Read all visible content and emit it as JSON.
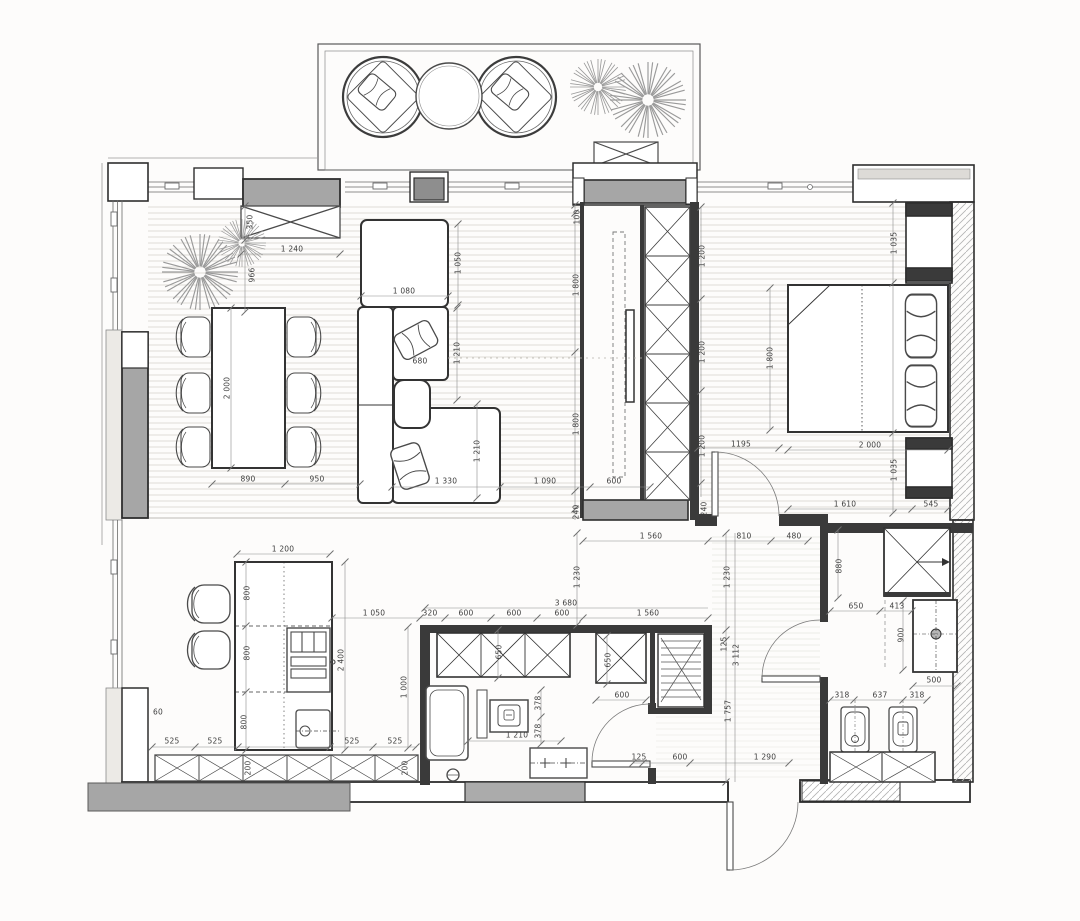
{
  "plan": {
    "title": "apartment-floor-plan",
    "units": "mm",
    "rooms": [
      "balcony",
      "living-dining-room",
      "bedroom",
      "kitchen",
      "bathroom-laundry",
      "hallway",
      "bathroom-2",
      "entrance-corridor"
    ],
    "furniture": [
      "lounge-chair",
      "lounge-chair",
      "round-coffee-table",
      "plant",
      "plant",
      "balcony-storage-box",
      "radiator-cabinet",
      "dining-table",
      "dining-chair-x6",
      "plant",
      "plant",
      "square-lounge-table",
      "corner-sofa",
      "ottoman",
      "chaise",
      "pillows",
      "tv",
      "tv-console",
      "wardrobe",
      "double-bed",
      "bed-pillow",
      "bed-pillow",
      "nightstand",
      "nightstand",
      "kitchen-island",
      "cooktop-oven",
      "island-sink",
      "bar-stool",
      "bar-stool",
      "base-cabinet-row",
      "wall-cabinet-row",
      "storage-box",
      "linen-closet",
      "bathtub",
      "washing-machine",
      "vanity-basin",
      "floor-drain",
      "shower",
      "vanity-sink",
      "toilet",
      "bidet",
      "bathroom-cabinets"
    ],
    "doors": [
      "bedroom-door",
      "bathroom-door",
      "bathroom2-door",
      "entrance-door"
    ],
    "colors": {
      "paper": "#fdfcfb",
      "wall_dark": "#2e2e2e",
      "wall_gray": "#a6a6a6",
      "wall_light": "#e9e7e3",
      "floor_line": "#dcd9d3",
      "dim_line": "#8c8c8c",
      "dim_text": "#3e3e3e"
    }
  },
  "dimensions": {
    "horizontal": [
      {
        "label": "1 240",
        "x": 292,
        "y": 249
      },
      {
        "label": "1 080",
        "x": 404,
        "y": 291
      },
      {
        "label": "680",
        "x": 420,
        "y": 361
      },
      {
        "label": "890",
        "x": 248,
        "y": 479
      },
      {
        "label": "950",
        "x": 317,
        "y": 479
      },
      {
        "label": "1 330",
        "x": 446,
        "y": 481
      },
      {
        "label": "1 090",
        "x": 545,
        "y": 481
      },
      {
        "label": "600",
        "x": 614,
        "y": 481
      },
      {
        "label": "1195",
        "x": 741,
        "y": 444
      },
      {
        "label": "2 000",
        "x": 870,
        "y": 445
      },
      {
        "label": "1 610",
        "x": 845,
        "y": 504
      },
      {
        "label": "545",
        "x": 931,
        "y": 504
      },
      {
        "label": "1 560",
        "x": 651,
        "y": 536
      },
      {
        "label": "810",
        "x": 744,
        "y": 536
      },
      {
        "label": "480",
        "x": 794,
        "y": 536
      },
      {
        "label": "1 200",
        "x": 283,
        "y": 549
      },
      {
        "label": "3 680",
        "x": 566,
        "y": 603
      },
      {
        "label": "1 050",
        "x": 374,
        "y": 613
      },
      {
        "label": "320",
        "x": 430,
        "y": 613
      },
      {
        "label": "600",
        "x": 466,
        "y": 613
      },
      {
        "label": "600",
        "x": 514,
        "y": 613
      },
      {
        "label": "600",
        "x": 562,
        "y": 613
      },
      {
        "label": "1 560",
        "x": 648,
        "y": 613
      },
      {
        "label": "650",
        "x": 856,
        "y": 606
      },
      {
        "label": "413",
        "x": 897,
        "y": 606
      },
      {
        "label": "600",
        "x": 622,
        "y": 695
      },
      {
        "label": "1 210",
        "x": 517,
        "y": 735
      },
      {
        "label": "525",
        "x": 172,
        "y": 741
      },
      {
        "label": "525",
        "x": 215,
        "y": 741
      },
      {
        "label": "525",
        "x": 352,
        "y": 741
      },
      {
        "label": "525",
        "x": 395,
        "y": 741
      },
      {
        "label": "125",
        "x": 639,
        "y": 757
      },
      {
        "label": "600",
        "x": 680,
        "y": 757
      },
      {
        "label": "1 290",
        "x": 765,
        "y": 757
      },
      {
        "label": "318",
        "x": 842,
        "y": 695
      },
      {
        "label": "637",
        "x": 880,
        "y": 695
      },
      {
        "label": "318",
        "x": 917,
        "y": 695
      },
      {
        "label": "500",
        "x": 934,
        "y": 680
      },
      {
        "label": "60",
        "x": 158,
        "y": 712
      }
    ],
    "vertical": [
      {
        "label": "350",
        "x": 250,
        "y": 222
      },
      {
        "label": "966",
        "x": 252,
        "y": 275
      },
      {
        "label": "100",
        "x": 577,
        "y": 217
      },
      {
        "label": "1 050",
        "x": 458,
        "y": 263
      },
      {
        "label": "1 800",
        "x": 576,
        "y": 285
      },
      {
        "label": "1 210",
        "x": 457,
        "y": 353
      },
      {
        "label": "2 000",
        "x": 227,
        "y": 388
      },
      {
        "label": "1 800",
        "x": 576,
        "y": 424
      },
      {
        "label": "1 210",
        "x": 477,
        "y": 451
      },
      {
        "label": "1 200",
        "x": 702,
        "y": 256
      },
      {
        "label": "1 200",
        "x": 702,
        "y": 352
      },
      {
        "label": "1 200",
        "x": 702,
        "y": 446
      },
      {
        "label": "1 800",
        "x": 770,
        "y": 358
      },
      {
        "label": "1 035",
        "x": 894,
        "y": 243
      },
      {
        "label": "1 035",
        "x": 894,
        "y": 470
      },
      {
        "label": "240",
        "x": 576,
        "y": 512
      },
      {
        "label": "240",
        "x": 704,
        "y": 509
      },
      {
        "label": "1 230",
        "x": 577,
        "y": 577
      },
      {
        "label": "1 230",
        "x": 727,
        "y": 577
      },
      {
        "label": "800",
        "x": 247,
        "y": 593
      },
      {
        "label": "800",
        "x": 247,
        "y": 653
      },
      {
        "label": "800",
        "x": 244,
        "y": 722
      },
      {
        "label": "2 400",
        "x": 341,
        "y": 660
      },
      {
        "label": "1 000",
        "x": 404,
        "y": 687
      },
      {
        "label": "650",
        "x": 499,
        "y": 652
      },
      {
        "label": "650",
        "x": 608,
        "y": 660
      },
      {
        "label": "125",
        "x": 724,
        "y": 644
      },
      {
        "label": "3 112",
        "x": 736,
        "y": 655
      },
      {
        "label": "1 757",
        "x": 728,
        "y": 711
      },
      {
        "label": "880",
        "x": 839,
        "y": 566
      },
      {
        "label": "900",
        "x": 901,
        "y": 635
      },
      {
        "label": "378",
        "x": 538,
        "y": 703
      },
      {
        "label": "378",
        "x": 538,
        "y": 731
      },
      {
        "label": "200",
        "x": 248,
        "y": 768
      },
      {
        "label": "200",
        "x": 405,
        "y": 768
      }
    ]
  }
}
